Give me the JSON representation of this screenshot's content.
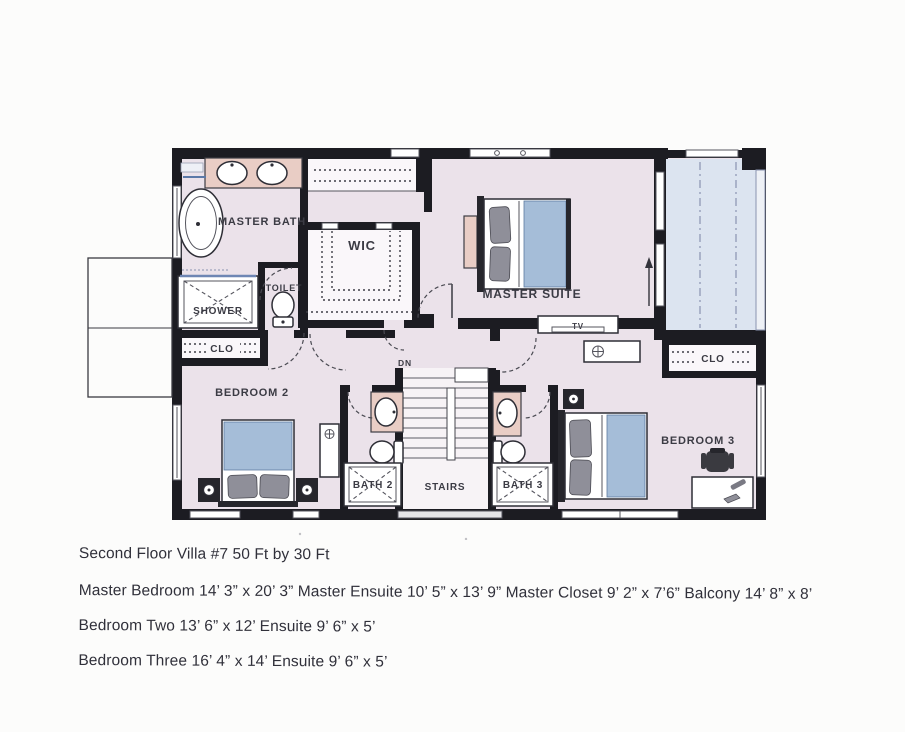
{
  "document": {
    "title": "Second Floor Villa #7 50 Ft by 30 Ft",
    "dimensions": [
      "Master Bedroom 14’ 3” x 20’ 3” Master Ensuite 10’ 5” x 13’ 9” Master Closet 9’ 2” x 7’6” Balcony 14’ 8” x 8’",
      "Bedroom Two 13’ 6” x 12’ Ensuite 9’ 6” x 5’",
      "Bedroom Three 16’ 4” x 14’ Ensuite 9’ 6” x 5’"
    ]
  },
  "plan": {
    "labels": {
      "master_bath": "MASTER BATH",
      "wic": "WIC",
      "master_suite": "MASTER SUITE",
      "toilet": "TOILET",
      "shower": "SHOWER",
      "closet_bedroom2": "CLO",
      "closet_bedroom3": "CLO",
      "bedroom2": "BEDROOM 2",
      "bedroom3": "BEDROOM 3",
      "bath2": "BATH 2",
      "bath3": "BATH 3",
      "stairs": "STAIRS",
      "tv": "TV",
      "down": "DN"
    }
  },
  "colors": {
    "paper": "#fcfcfb",
    "ink": "#30303a",
    "wall": "#1c1c22",
    "room_fill": "#ebe2ea",
    "balcony_fill": "#dce4f0",
    "counter_pink": "#e9cdc5",
    "bedding_blue": "#a5bdd8",
    "pillow_gray": "#8f8f99"
  }
}
